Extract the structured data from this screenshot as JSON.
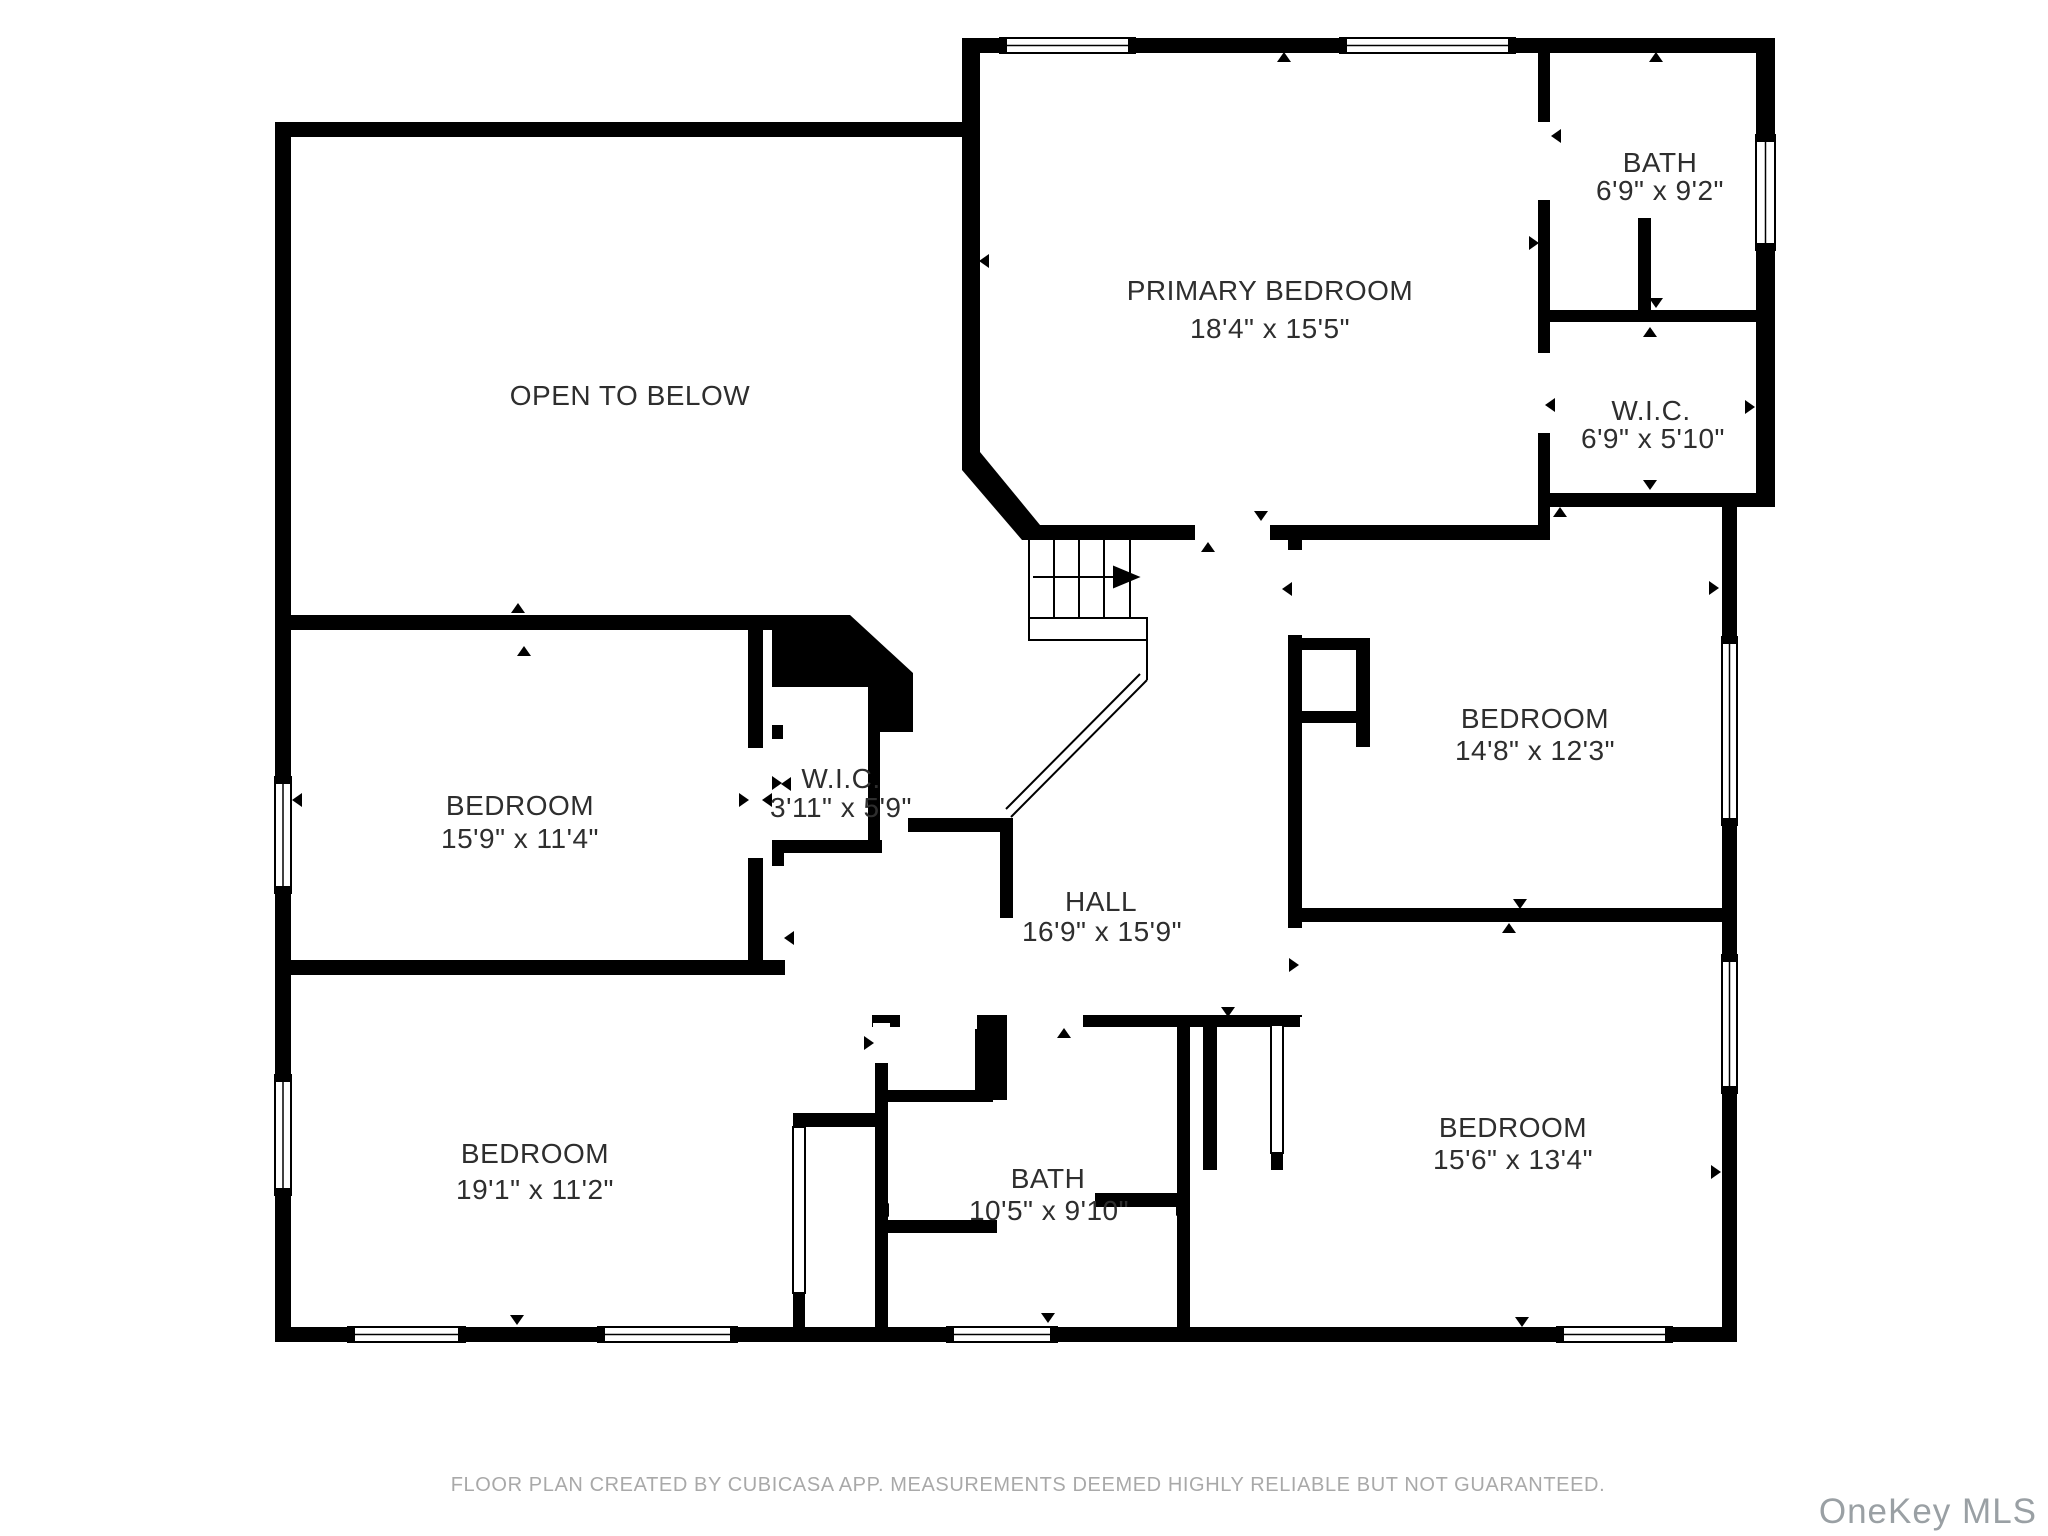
{
  "title": "Second floor plan",
  "colors": {
    "wall": "#000000",
    "background": "#ffffff",
    "label_text": "#2e2e2e",
    "footer_text": "#a9a9a9",
    "watermark_text": "#9aa0a4"
  },
  "icons": {
    "stairs": "stairs-icon",
    "door_marker": "door-direction-marker-icon",
    "window": "window-icon",
    "sliding_door": "sliding-door-icon"
  },
  "rooms": [
    {
      "id": "open-to-below",
      "name": "OPEN TO BELOW",
      "dims": ""
    },
    {
      "id": "primary-bedroom",
      "name": "PRIMARY BEDROOM",
      "dims": "18'4\" x 15'5\""
    },
    {
      "id": "bath-upper",
      "name": "BATH",
      "dims": "6'9\" x 9'2\""
    },
    {
      "id": "wic-upper",
      "name": "W.I.C.",
      "dims": "6'9\" x 5'10\""
    },
    {
      "id": "bedroom-right",
      "name": "BEDROOM",
      "dims": "14'8\" x 12'3\""
    },
    {
      "id": "bedroom-left-upper",
      "name": "BEDROOM",
      "dims": "15'9\" x 11'4\""
    },
    {
      "id": "wic-small",
      "name": "W.I.C.",
      "dims": "3'11\" x 5'9\""
    },
    {
      "id": "hall",
      "name": "HALL",
      "dims": "16'9\" x 15'9\""
    },
    {
      "id": "bedroom-left-lower",
      "name": "BEDROOM",
      "dims": "19'1\" x 11'2\""
    },
    {
      "id": "bath-lower",
      "name": "BATH",
      "dims": "10'5\" x 9'10\""
    },
    {
      "id": "bedroom-right-lower",
      "name": "BEDROOM",
      "dims": "15'6\" x 13'4\""
    }
  ],
  "footer": {
    "note": "FLOOR PLAN CREATED BY CUBICASA APP. MEASUREMENTS DEEMED HIGHLY RELIABLE BUT NOT GUARANTEED."
  },
  "watermark": {
    "label": "OneKey MLS"
  }
}
